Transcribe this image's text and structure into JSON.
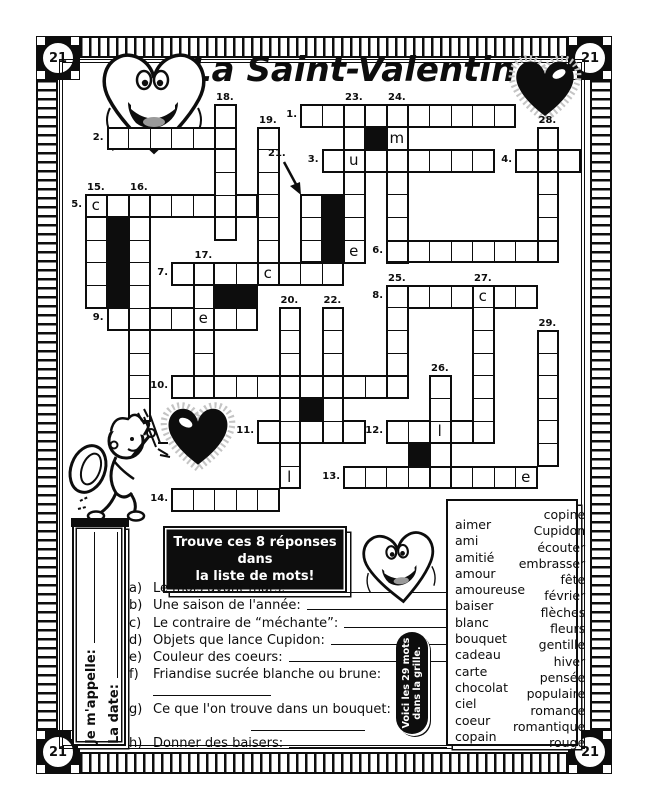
{
  "page": {
    "corner_label": "21",
    "title": "La Saint-Valentin"
  },
  "instructions": {
    "line1": "Trouve ces 8 réponses dans",
    "line2": "la liste de mots!"
  },
  "badge": {
    "line1": "Voici les 29 mots",
    "line2": "dans la grille."
  },
  "name_fields": {
    "name_label": "Je m'appelle:",
    "date_label": "La date:"
  },
  "clues": [
    {
      "k": "a)",
      "t": "Le mois avant mars:",
      "wrap": false
    },
    {
      "k": "b)",
      "t": "Une saison de l'année:",
      "wrap": false
    },
    {
      "k": "c)",
      "t": "Le contraire de “méchante”:",
      "wrap": false
    },
    {
      "k": "d)",
      "t": "Objets que lance Cupidon:",
      "wrap": false
    },
    {
      "k": "e)",
      "t": "Couleur des coeurs:",
      "wrap": false
    },
    {
      "k": "f)",
      "t": "Friandise sucrée blanche ou brune:",
      "wrap": true,
      "indent": 24,
      "linewidth": 118
    },
    {
      "k": "g)",
      "t": "Ce que l'on trouve dans un bouquet:",
      "wrap": true,
      "indent": 122,
      "linewidth": 114
    },
    {
      "k": "h)",
      "t": "Donner des baisers:",
      "wrap": false
    }
  ],
  "word_list": {
    "left": [
      "aimer",
      "ami",
      "amitié",
      "amour",
      "amoureuse",
      "baiser",
      "blanc",
      "bouquet",
      "cadeau",
      "carte",
      "chocolat",
      "ciel",
      "coeur",
      "copain"
    ],
    "right": [
      "copine",
      "Cupidon",
      "écouter",
      "embrasser",
      "fête",
      "février",
      "flèches",
      "fleurs",
      "gentille",
      "hiver",
      "pensée",
      "populaire",
      "romance",
      "romantique",
      "rouge"
    ]
  },
  "crossword": {
    "origin_x": 85,
    "origin_y": 104,
    "cell_w": 21.5,
    "cell_h": 22.6,
    "slots": [
      {
        "num": "1.",
        "row": 0,
        "col": 10,
        "len": 10,
        "dir": "across"
      },
      {
        "num": "2.",
        "row": 1,
        "col": 1,
        "len": 6,
        "dir": "across"
      },
      {
        "num": "3.",
        "row": 2,
        "col": 11,
        "len": 8,
        "dir": "across"
      },
      {
        "num": "4.",
        "row": 2,
        "col": 20,
        "len": 3,
        "dir": "across"
      },
      {
        "num": "5.",
        "row": 4,
        "col": 0,
        "len": 8,
        "dir": "across"
      },
      {
        "num": "6.",
        "row": 6,
        "col": 14,
        "len": 8,
        "dir": "across"
      },
      {
        "num": "7.",
        "row": 7,
        "col": 4,
        "len": 8,
        "dir": "across"
      },
      {
        "num": "8.",
        "row": 8,
        "col": 14,
        "len": 7,
        "dir": "across"
      },
      {
        "num": "9.",
        "row": 9,
        "col": 1,
        "len": 7,
        "dir": "across"
      },
      {
        "num": "10.",
        "row": 12,
        "col": 4,
        "len": 11,
        "dir": "across"
      },
      {
        "num": "11.",
        "row": 14,
        "col": 8,
        "len": 5,
        "dir": "across"
      },
      {
        "num": "12.",
        "row": 14,
        "col": 14,
        "len": 5,
        "dir": "across"
      },
      {
        "num": "13.",
        "row": 16,
        "col": 12,
        "len": 9,
        "dir": "across"
      },
      {
        "num": "14.",
        "row": 17,
        "col": 4,
        "len": 5,
        "dir": "across"
      },
      {
        "num": "15.",
        "row": 4,
        "col": 0,
        "len": 5,
        "dir": "down"
      },
      {
        "num": "16.",
        "row": 4,
        "col": 2,
        "len": 10,
        "dir": "down"
      },
      {
        "num": "17.",
        "row": 7,
        "col": 5,
        "len": 6,
        "dir": "down"
      },
      {
        "num": "18.",
        "row": 0,
        "col": 6,
        "len": 6,
        "dir": "down"
      },
      {
        "num": "19.",
        "row": 1,
        "col": 8,
        "len": 7,
        "dir": "down"
      },
      {
        "num": "20.",
        "row": 9,
        "col": 9,
        "len": 8,
        "dir": "down"
      },
      {
        "num": "21.",
        "row": 4,
        "col": 10,
        "len": 3,
        "dir": "down",
        "arrow": true
      },
      {
        "num": "22.",
        "row": 9,
        "col": 11,
        "len": 6,
        "dir": "down"
      },
      {
        "num": "23.",
        "row": 0,
        "col": 12,
        "len": 7,
        "dir": "down"
      },
      {
        "num": "24.",
        "row": 0,
        "col": 14,
        "len": 7,
        "dir": "down"
      },
      {
        "num": "25.",
        "row": 8,
        "col": 14,
        "len": 5,
        "dir": "down"
      },
      {
        "num": "26.",
        "row": 12,
        "col": 16,
        "len": 5,
        "dir": "down"
      },
      {
        "num": "27.",
        "row": 8,
        "col": 18,
        "len": 7,
        "dir": "down"
      },
      {
        "num": "28.",
        "row": 1,
        "col": 21,
        "len": 6,
        "dir": "down"
      },
      {
        "num": "29.",
        "row": 10,
        "col": 21,
        "len": 6,
        "dir": "down"
      }
    ],
    "black_cells": [
      [
        1,
        13
      ],
      [
        4,
        11
      ],
      [
        5,
        11
      ],
      [
        6,
        11
      ],
      [
        5,
        1
      ],
      [
        6,
        1
      ],
      [
        7,
        1
      ],
      [
        8,
        1
      ],
      [
        8,
        6
      ],
      [
        8,
        7
      ],
      [
        13,
        10
      ],
      [
        15,
        15
      ]
    ],
    "prefills": [
      {
        "row": 4,
        "col": 0,
        "letter": "c"
      },
      {
        "row": 2,
        "col": 12,
        "letter": "u"
      },
      {
        "row": 1,
        "col": 14,
        "letter": "m"
      },
      {
        "row": 6,
        "col": 12,
        "letter": "e"
      },
      {
        "row": 7,
        "col": 8,
        "letter": "c"
      },
      {
        "row": 8,
        "col": 18,
        "letter": "c"
      },
      {
        "row": 9,
        "col": 5,
        "letter": "e"
      },
      {
        "row": 14,
        "col": 16,
        "letter": "l"
      },
      {
        "row": 16,
        "col": 9,
        "letter": "l"
      },
      {
        "row": 16,
        "col": 20,
        "letter": "e"
      }
    ],
    "arrow_label": "21."
  }
}
